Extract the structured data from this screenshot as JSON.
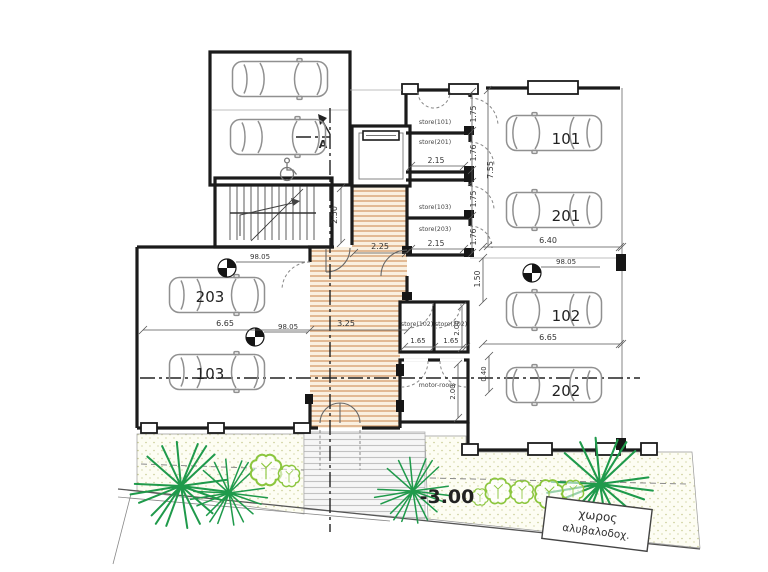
{
  "labels": {
    "store101": "store(101)",
    "store201": "store(201)",
    "store103": "store(103)",
    "store203": "store(203)",
    "store102": "store(102)",
    "store202": "store(202)",
    "motor_room": "motor-room",
    "p101": "101",
    "p201": "201",
    "p102": "102",
    "p202": "202",
    "p103": "103",
    "p203": "203"
  },
  "dims": {
    "w215a": "2.15",
    "w215b": "2.15",
    "h175a": "1.75",
    "h176a": "1.76",
    "h175b": "1.75",
    "h176b": "1.76",
    "v755": "7.55",
    "w640": "6.40",
    "w665r": "6.65",
    "w665l": "6.65",
    "w325": "3.25",
    "w225": "2.25",
    "v250": "2.50",
    "w165a": "1.65",
    "w165b": "1.65",
    "v200": "2.00",
    "v150": "1.50",
    "v040": "0.40",
    "v200m": "2.00"
  },
  "levels": {
    "spot1": "98.05",
    "spot2": "98.05",
    "spot3": "98.05",
    "street_level": "-3.00"
  },
  "annot": {
    "section_letter": "A",
    "greek_line1": "χωρος",
    "greek_line2": "αλυβαλοδοχ."
  },
  "colors": {
    "wall": "#1b1b1b",
    "wood_line": "#d8a273",
    "wood_bg": "#faf0e0",
    "stipple_dot": "#c6c98e",
    "stipple_bg": "#fdfdf3",
    "ramp_line": "#c2c2c2",
    "plant_dark": "#1f9a4b",
    "plant_light": "#8cc63e",
    "car_line": "#909090",
    "dim_text": "#333333"
  }
}
